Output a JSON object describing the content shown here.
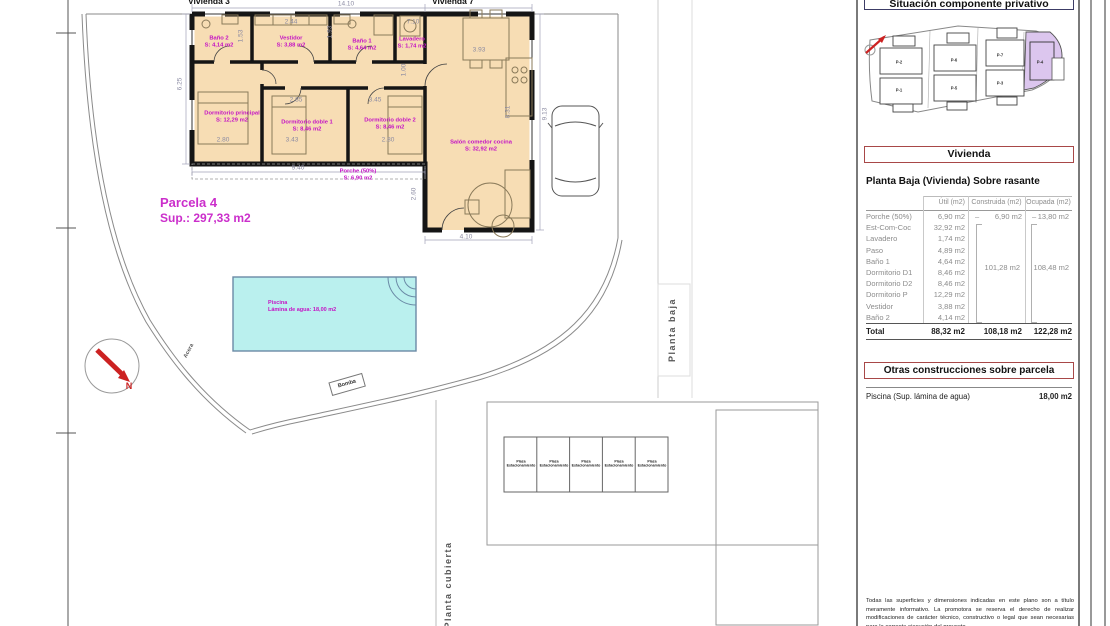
{
  "colors": {
    "accent_magenta": "#c413c4",
    "wall_black": "#1a1a1a",
    "floor_fill": "#f7ddb4",
    "pool_fill": "#baf0ee",
    "highlight_purple": "#dcc6ee",
    "header_box_red": "#a84848",
    "north_red": "#cc2222"
  },
  "plan": {
    "vivienda_left": "Vivienda 3",
    "vivienda_right": "Vivienda 7",
    "parcela_title": "Parcela 4",
    "parcela_sup": "Sup.: 297,33 m2",
    "rooms": [
      {
        "name": "Baño 2",
        "area": "S: 4,14 m2"
      },
      {
        "name": "Vestidor",
        "area": "S: 3,88 m2"
      },
      {
        "name": "Baño 1",
        "area": "S: 4,64 m2"
      },
      {
        "name": "Lavadero",
        "area": "S: 1,74 m2"
      },
      {
        "name": "Dormitorio principal",
        "area": "S: 12,29 m2"
      },
      {
        "name": "Dormitorio doble 1",
        "area": "S: 8,46 m2"
      },
      {
        "name": "Dormitorio doble 2",
        "area": "S: 8,46 m2"
      },
      {
        "name": "Salón comedor cocina",
        "area": "S: 32,92 m2"
      },
      {
        "name": "Porche (50%)",
        "area": "S: 6,90 m2"
      }
    ],
    "pool": {
      "name": "Piscina",
      "area": "Lámina de agua: 18,00 m2"
    },
    "dims": [
      "14.10",
      "2.44",
      "1.53",
      "1.93",
      "7.10",
      "3.93",
      "1.00",
      "2.85",
      "3.45",
      "2.80",
      "3.43",
      "2.80",
      "9.40",
      "8.31",
      "9.13",
      "6.25",
      "2.60",
      "4.10"
    ],
    "acera": "Acera",
    "bomba": "Bomba",
    "north": "N",
    "planta_baja": "Planta baja",
    "planta_cubierta": "Planta cubierta",
    "parking_line1": "Plaza",
    "parking_line2": "Estacionamiento"
  },
  "sitemap": {
    "title": "Situación componente privativo",
    "parcels": [
      "P-2",
      "P-1",
      "P-6",
      "P-5",
      "P-7",
      "P-3",
      "P-4"
    ],
    "highlighted": "P-4"
  },
  "panel": {
    "vivienda_title": "Vivienda",
    "section_title": "Planta Baja (Vivienda) Sobre rasante",
    "col_util": "Útil (m2)",
    "col_construida": "Construida (m2)",
    "col_ocupada": "Ocupada (m2)",
    "dash": "–",
    "rows": [
      {
        "label": "Porche (50%)",
        "util": "6,90 m2",
        "construida": "6,90 m2",
        "ocupada": "13,80 m2"
      },
      {
        "label": "Est-Com-Coc",
        "util": "32,92 m2"
      },
      {
        "label": "Lavadero",
        "util": "1,74 m2"
      },
      {
        "label": "Paso",
        "util": "4,89 m2"
      },
      {
        "label": "Baño 1",
        "util": "4,64 m2"
      },
      {
        "label": "Dormitorio D1",
        "util": "8,46 m2"
      },
      {
        "label": "Dormitorio D2",
        "util": "8,46 m2"
      },
      {
        "label": "Dormitorio P",
        "util": "12,29 m2"
      },
      {
        "label": "Vestidor",
        "util": "3,88 m2"
      },
      {
        "label": "Baño 2",
        "util": "4,14 m2"
      }
    ],
    "construida_group": "101,28 m2",
    "ocupada_group": "108,48 m2",
    "total": {
      "label": "Total",
      "util": "88,32 m2",
      "construida": "108,18 m2",
      "ocupada": "122,28 m2"
    },
    "otras_title": "Otras construcciones sobre parcela",
    "otras_row_label": "Piscina (Sup. lámina de agua)",
    "otras_row_value": "18,00 m2",
    "disclaimer": "Todas las superficies y dimensiones indicadas en este plano son a título meramente informativo. La promotora se reserva el derecho de realizar modificaciones de carácter técnico, constructivo o legal que sean necesarias para la correcta ejecución del proyecto,"
  }
}
